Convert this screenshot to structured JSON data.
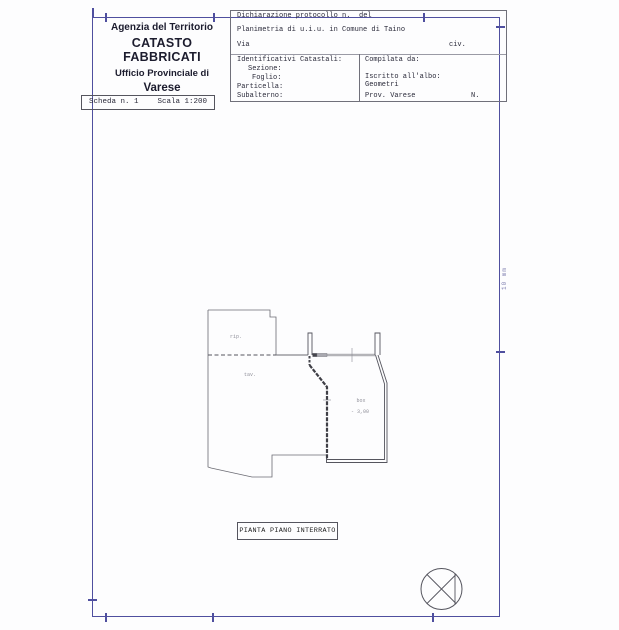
{
  "colors": {
    "frame_blue": "#4f4f9f",
    "ink": "#2a2a3a",
    "separator_gray": "#9a9aa5",
    "plan_line": "#6b6b73"
  },
  "header_left": {
    "agency": "Agenzia del Territorio",
    "registry": "CATASTO FABBRICATI",
    "office_line": "Ufficio Provinciale di",
    "province": "Varese"
  },
  "sheet_bar": {
    "sheet": "Scheda n. 1",
    "scale": "Scala 1:200"
  },
  "form": {
    "protocol_label": "Dichiarazione protocollo n.",
    "protocol_del": "del",
    "planimetria_line": "Planimetria di u.i.u. in Comune di Taino",
    "via_label": "Via",
    "civ_label": "civ.",
    "cadastral_title": "Identificativi Catastali:",
    "cadastral_fields": {
      "sezione": "Sezione:",
      "foglio": "Foglio:",
      "particella": "Particella:",
      "subalterno": "Subalterno:"
    },
    "compiled_title": "Compilata da:",
    "album_label": "Iscritto all'albo:",
    "album_value": "Geometri",
    "province_label": "Prov. Varese",
    "number_label": "N."
  },
  "plan": {
    "caption": "PIANTA PIANO INTERRATO",
    "rooms": {
      "a": "rip.",
      "b": "tav.",
      "c": "box"
    },
    "level": "- 3,00"
  },
  "margin_note": "10 mm"
}
